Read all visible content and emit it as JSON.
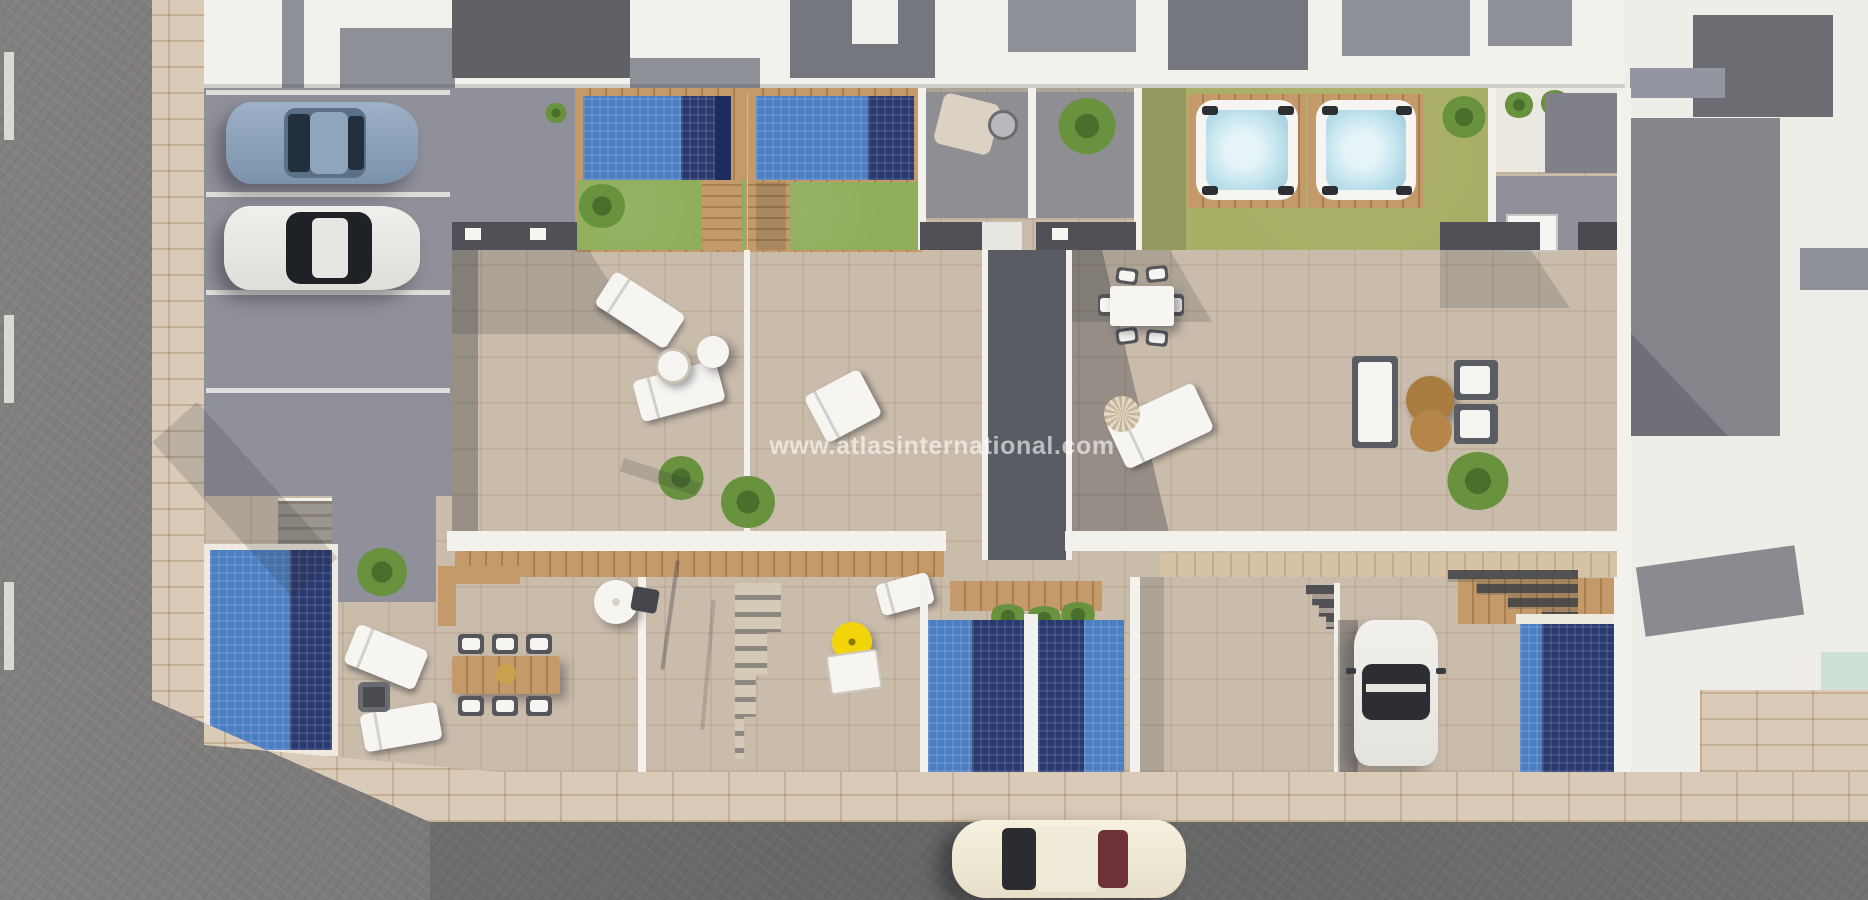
{
  "watermark": {
    "text": "www.atlasinternational.com"
  },
  "labels": {
    "scene": "Aerial 3D render of four townhouses with pools",
    "streetLeft": "Street (west side)",
    "streetBottom": "Street (south side)",
    "sidewalk": "Pavement",
    "parking": "Parking bays",
    "carBlue": "Parked steel-blue car",
    "carWhiteParked": "Parked white car",
    "carDriveway": "White car in driveway",
    "carStreet": "Cream car on street",
    "garden1": "Garden with pool - unit 1",
    "garden2": "Garden with pool - unit 2",
    "hotTubGarden": "Lawn with hot tubs - units 3 and 4",
    "terrace1": "Terrace - unit 1",
    "terrace2": "Terrace - unit 2",
    "terrace3": "Terrace - unit 3",
    "terrace4": "Terrace - unit 4",
    "plungePools": "Plunge pools",
    "frontPool": "Front garden pool",
    "outdoorKitchen": "Outdoor kitchen",
    "neighbours": "Neighbouring buildings",
    "diningSet": "Outdoor dining set",
    "loungeSet": "Outdoor lounge set"
  },
  "palette": {
    "asphalt": "#7b7977",
    "sidewalk": "#d9cbb7",
    "tile": "#cabcab",
    "whiteWall": "#f3f1ec",
    "roofDark": "#5f6165",
    "roofMid": "#75777e",
    "roofLight": "#8e9097",
    "pave": "#90909a",
    "patio": "#8e8e93",
    "lawn": "#8fae5c",
    "lawnOlive": "#a9af67",
    "wood": "#c59a6a",
    "woodDark": "#a97f4f",
    "poolBlue": "#4c7ec2",
    "poolNavy": "#28396f",
    "poolDeep": "#1d2c5e",
    "tub": "#c2e4ee",
    "carSteel": "#8ba1b9",
    "carWhite": "#edebe7",
    "carCream": "#f2ecd9",
    "maroon": "#6e3138",
    "umbrella": "#f2d40a",
    "plant": "#69923f",
    "plantDark": "#48702c",
    "glassGreen": "#cfe0d6",
    "rug": "#dbd2c3",
    "counter": "#4f5156",
    "white": "#f6f5f2"
  }
}
